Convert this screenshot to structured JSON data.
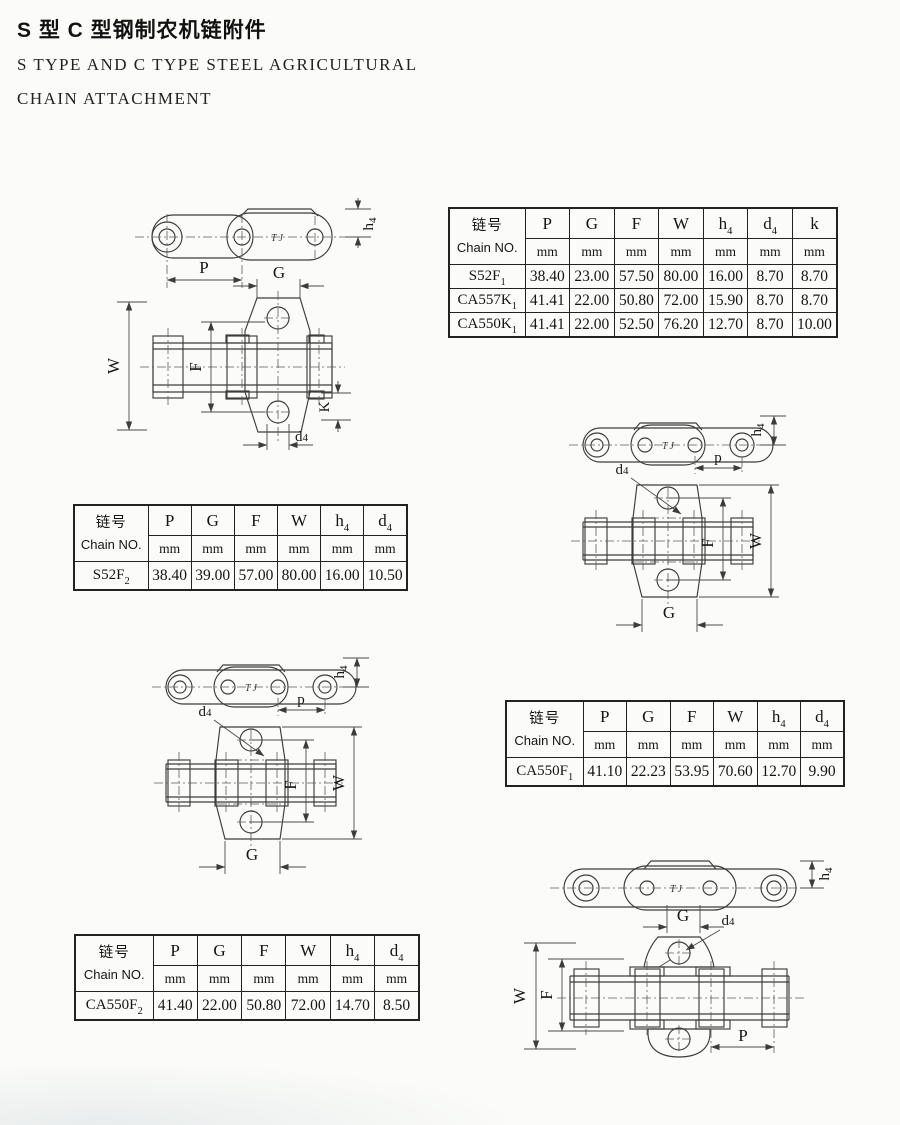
{
  "page": {
    "title_zh": "S 型 C 型钢制农机链附件",
    "title_en1": "S TYPE AND C TYPE STEEL AGRICULTURAL",
    "title_en2": "CHAIN ATTACHMENT"
  },
  "common": {
    "chain_no_zh": "链号",
    "chain_no_en": "Chain NO.",
    "unit": "mm"
  },
  "drawings": {
    "tj": "TJ",
    "p_upper": "P",
    "p_lower": "p",
    "g": "G",
    "w": "W",
    "f": "F",
    "k": "K",
    "h": "h",
    "d": "d",
    "four": "4"
  },
  "table1": {
    "cols": [
      {
        "b": "P",
        "s": ""
      },
      {
        "b": "G",
        "s": ""
      },
      {
        "b": "F",
        "s": ""
      },
      {
        "b": "W",
        "s": ""
      },
      {
        "b": "h",
        "s": "4"
      },
      {
        "b": "d",
        "s": "4"
      },
      {
        "b": "k",
        "s": ""
      }
    ],
    "rows": [
      {
        "no_b": "S52F",
        "no_s": "1",
        "v": [
          "38.40",
          "23.00",
          "57.50",
          "80.00",
          "16.00",
          "8.70",
          "8.70"
        ]
      },
      {
        "no_b": "CA557K",
        "no_s": "1",
        "v": [
          "41.41",
          "22.00",
          "50.80",
          "72.00",
          "15.90",
          "8.70",
          "8.70"
        ]
      },
      {
        "no_b": "CA550K",
        "no_s": "1",
        "v": [
          "41.41",
          "22.00",
          "52.50",
          "76.20",
          "12.70",
          "8.70",
          "10.00"
        ]
      }
    ]
  },
  "table2": {
    "cols": [
      {
        "b": "P",
        "s": ""
      },
      {
        "b": "G",
        "s": ""
      },
      {
        "b": "F",
        "s": ""
      },
      {
        "b": "W",
        "s": ""
      },
      {
        "b": "h",
        "s": "4"
      },
      {
        "b": "d",
        "s": "4"
      }
    ],
    "rows": [
      {
        "no_b": "S52F",
        "no_s": "2",
        "v": [
          "38.40",
          "39.00",
          "57.00",
          "80.00",
          "16.00",
          "10.50"
        ]
      }
    ]
  },
  "table3": {
    "cols": [
      {
        "b": "P",
        "s": ""
      },
      {
        "b": "G",
        "s": ""
      },
      {
        "b": "F",
        "s": ""
      },
      {
        "b": "W",
        "s": ""
      },
      {
        "b": "h",
        "s": "4"
      },
      {
        "b": "d",
        "s": "4"
      }
    ],
    "rows": [
      {
        "no_b": "CA550F",
        "no_s": "1",
        "v": [
          "41.10",
          "22.23",
          "53.95",
          "70.60",
          "12.70",
          "9.90"
        ]
      }
    ]
  },
  "table4": {
    "cols": [
      {
        "b": "P",
        "s": ""
      },
      {
        "b": "G",
        "s": ""
      },
      {
        "b": "F",
        "s": ""
      },
      {
        "b": "W",
        "s": ""
      },
      {
        "b": "h",
        "s": "4"
      },
      {
        "b": "d",
        "s": "4"
      }
    ],
    "rows": [
      {
        "no_b": "CA550F",
        "no_s": "2",
        "v": [
          "41.40",
          "22.00",
          "50.80",
          "72.00",
          "14.70",
          "8.50"
        ]
      }
    ]
  }
}
